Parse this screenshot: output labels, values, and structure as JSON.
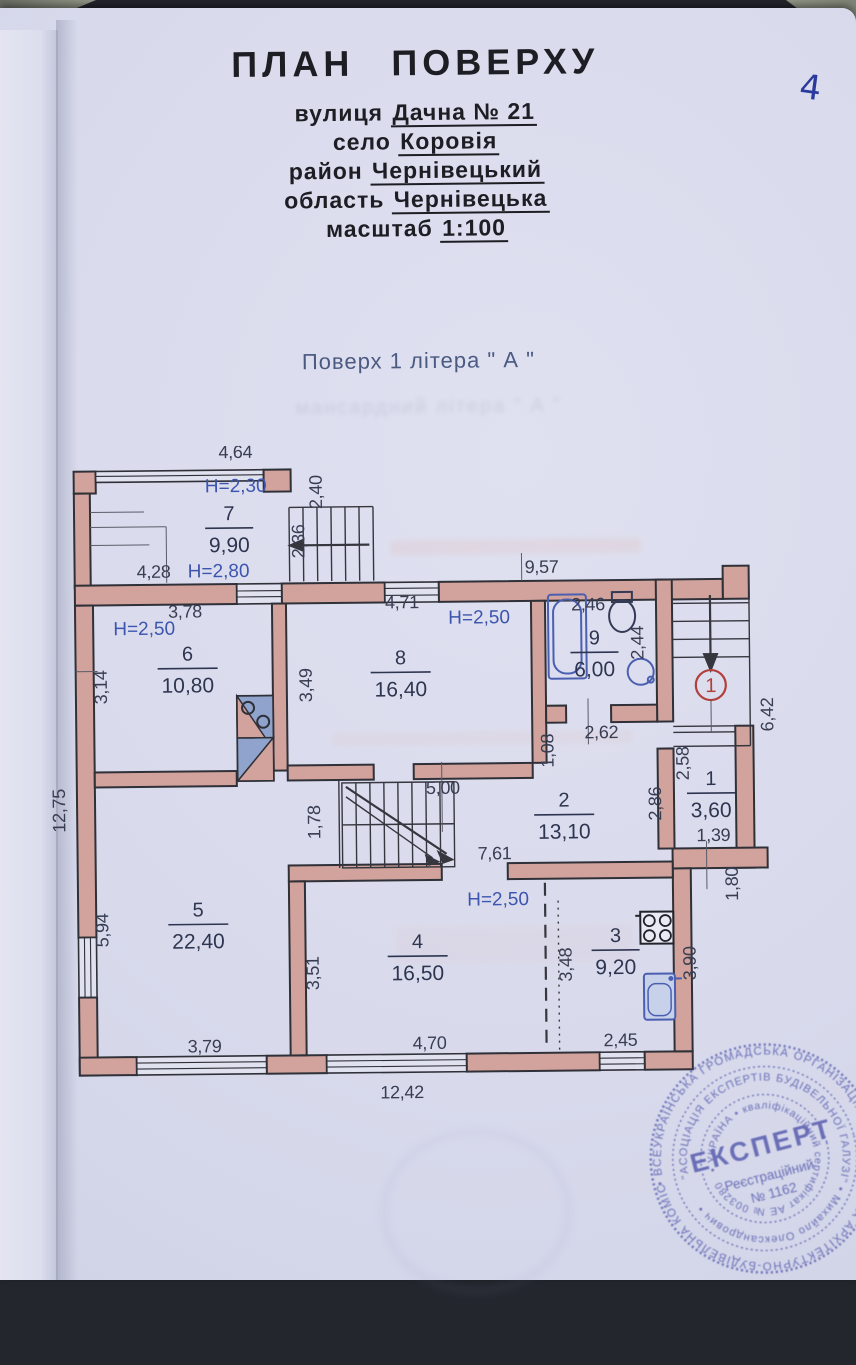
{
  "page": {
    "corner_number": "4"
  },
  "header": {
    "title": "ПЛАН ПОВЕРХУ",
    "fields": [
      {
        "label": "вулиця",
        "value": "Дачна № 21"
      },
      {
        "label": "село",
        "value": "Коровія"
      },
      {
        "label": "район",
        "value": "Чернівецький"
      },
      {
        "label": "область",
        "value": "Чернівецька"
      },
      {
        "label": "масштаб",
        "value": "1:100"
      }
    ],
    "floor_line": "Поверх 1 літера \" А \"",
    "bleed_line": "мансардний літера \" А \""
  },
  "plan": {
    "colors": {
      "wall": "#d1a39c",
      "dim": "#383d52",
      "height": "#3c55ae",
      "room": "#2e3550",
      "marker": "#b23f3a"
    },
    "rooms": [
      {
        "num": "7",
        "area": "9,90",
        "x": 248,
        "y": 524
      },
      {
        "num": "6",
        "area": "10,80",
        "x": 205,
        "y": 664
      },
      {
        "num": "8",
        "area": "16,40",
        "x": 418,
        "y": 670
      },
      {
        "num": "9",
        "area": "6,00",
        "x": 612,
        "y": 652
      },
      {
        "num": "2",
        "area": "13,10",
        "x": 580,
        "y": 814
      },
      {
        "num": "1",
        "area": "3,60",
        "x": 727,
        "y": 794
      },
      {
        "num": "5",
        "area": "22,40",
        "x": 213,
        "y": 920
      },
      {
        "num": "4",
        "area": "16,50",
        "x": 432,
        "y": 954
      },
      {
        "num": "3",
        "area": "9,20",
        "x": 630,
        "y": 950
      }
    ],
    "height_labels": [
      {
        "t": "Н=2,30",
        "x": 255,
        "y": 496
      },
      {
        "t": "Н=2,80",
        "x": 237,
        "y": 581
      },
      {
        "t": "Н=2,50",
        "x": 162,
        "y": 638
      },
      {
        "t": "Н=2,50",
        "x": 497,
        "y": 630
      },
      {
        "t": "Н=2,50",
        "x": 513,
        "y": 912
      }
    ],
    "dims_h": [
      {
        "t": "4,64",
        "x": 255,
        "y": 462
      },
      {
        "t": "4,28",
        "x": 172,
        "y": 581
      },
      {
        "t": "9,57",
        "x": 560,
        "y": 580
      },
      {
        "t": "3,78",
        "x": 203,
        "y": 621
      },
      {
        "t": "4,71",
        "x": 420,
        "y": 614
      },
      {
        "t": "2,46",
        "x": 606,
        "y": 618
      },
      {
        "t": "2,62",
        "x": 618,
        "y": 746
      },
      {
        "t": "5,00",
        "x": 459,
        "y": 800
      },
      {
        "t": "7,61",
        "x": 510,
        "y": 866
      },
      {
        "t": "1,39",
        "x": 729,
        "y": 850
      },
      {
        "t": "4,70",
        "x": 443,
        "y": 1055
      },
      {
        "t": "2,45",
        "x": 634,
        "y": 1054
      },
      {
        "t": "3,79",
        "x": 218,
        "y": 1056
      },
      {
        "t": "12,42",
        "x": 415,
        "y": 1104
      }
    ],
    "dims_v": [
      {
        "t": "2,40",
        "x": 341,
        "y": 497
      },
      {
        "t": "2,36",
        "x": 323,
        "y": 546
      },
      {
        "t": "3,14",
        "x": 124,
        "y": 690
      },
      {
        "t": "3,49",
        "x": 329,
        "y": 690
      },
      {
        "t": "2,44",
        "x": 661,
        "y": 651
      },
      {
        "t": "6,42",
        "x": 790,
        "y": 724
      },
      {
        "t": "1,08",
        "x": 570,
        "y": 758
      },
      {
        "t": "2,58",
        "x": 705,
        "y": 772
      },
      {
        "t": "2,86",
        "x": 677,
        "y": 812
      },
      {
        "t": "1,80",
        "x": 753,
        "y": 893
      },
      {
        "t": "1,78",
        "x": 336,
        "y": 827
      },
      {
        "t": "12,75",
        "x": 81,
        "y": 813
      },
      {
        "t": "5,94",
        "x": 123,
        "y": 933
      },
      {
        "t": "3,51",
        "x": 333,
        "y": 978
      },
      {
        "t": "3,48",
        "x": 586,
        "y": 972
      },
      {
        "t": "3,90",
        "x": 710,
        "y": 972
      }
    ],
    "entrance_marker": "1"
  },
  "stamp": {
    "outer_ring": "• ВСЕУКРАЇНСЬКА ГРОМАДСЬКА ОРГАНІЗАЦІЯ • АТЕСТАЦІЙНА АРХІТЕКТУРНО-БУДІВЕЛЬНА КОМІСІЯ • З ІНВЕНТАРИЗАЦІЇ НЕРУХОМОГО МАЙНА",
    "middle_ring": "\"АСОЦІАЦІЯ ЕКСПЕРТІВ БУДІВЕЛЬНОЇ ГАЛУЗІ\"  •  Михайло Олександрович  •",
    "inner_ring": "• УКРАЇНА •  кваліфікаційний сертифікат АЕ № 003280",
    "center_title": "ЕКСПЕРТ",
    "center_line1": "Реєстраційний",
    "center_line2": "№ 1162"
  }
}
